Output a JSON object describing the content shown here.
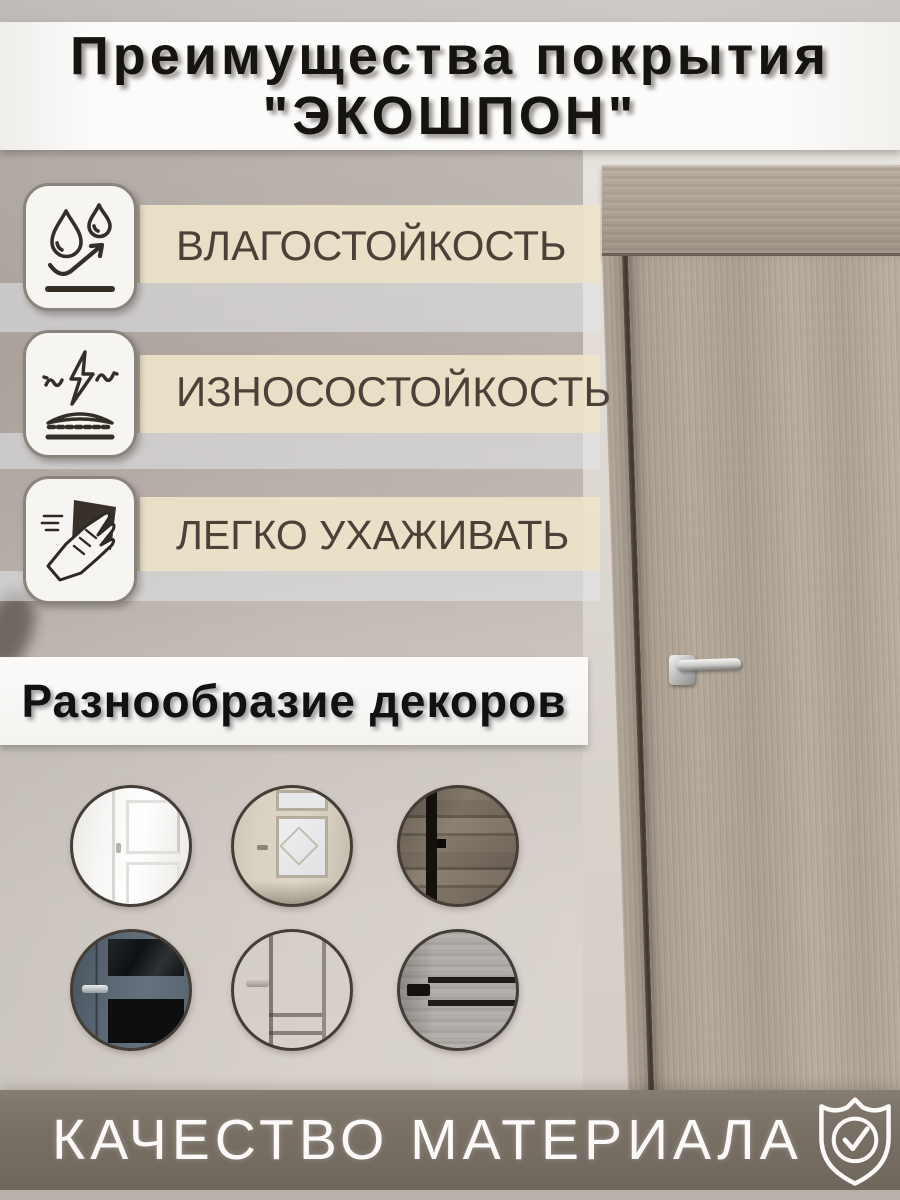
{
  "title": {
    "line1": "Преимущества покрытия",
    "line2": "\"ЭКОШПОН\""
  },
  "features": [
    {
      "label": "ВЛАГОСТОЙКОСТЬ",
      "icon": "water-drops-icon"
    },
    {
      "label": "ИЗНОСОСТОЙКОСТЬ",
      "icon": "impact-resistance-icon"
    },
    {
      "label": "ЛЕГКО УХАЖИВАТЬ",
      "icon": "wipe-hand-icon"
    }
  ],
  "decors": {
    "heading": "Разнообразие декоров",
    "items": [
      "white-classic-panel-door",
      "ivory-door-with-lattice-glass",
      "dark-rustic-plank-door",
      "slate-blue-door-with-dark-glass",
      "taupe-classic-panel-door",
      "light-grey-plank-door-with-black-inserts"
    ]
  },
  "footer": {
    "label": "КАЧЕСТВО МАТЕРИАЛА",
    "icon": "quality-shield-check-icon"
  },
  "scene": {
    "subject": "light-oak interior door with chrome lever handle"
  },
  "colors": {
    "banner_bg": "#fbfaf8",
    "title_text": "#151411",
    "feature_text": "#4b4138",
    "beige_band": "#ede3c9",
    "light_band": "#e4e5eb",
    "wall": "#b9b1aa",
    "door_wood": "#b0a496",
    "footer_band": "#7a7166",
    "footer_text": "#fbfaf8"
  }
}
